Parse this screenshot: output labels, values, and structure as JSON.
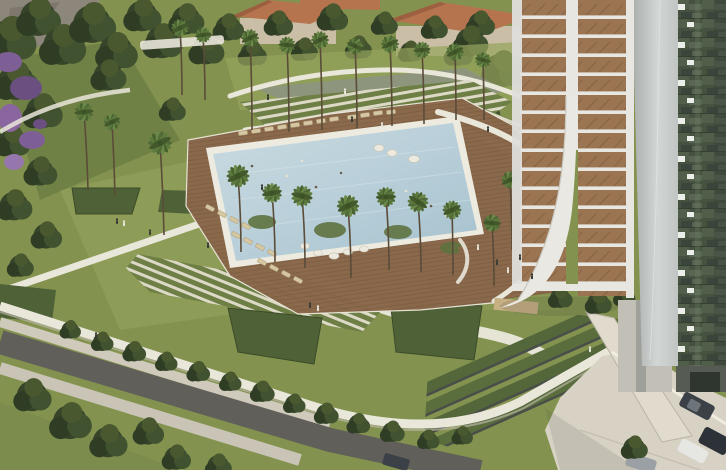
{
  "image": {
    "width": 726,
    "height": 470,
    "kind": "aerial architectural rendering",
    "subject": "resort-style residential development: landscaped pool podium beside a high-rise balcony tower"
  },
  "elements": {
    "background": "wooded hillside with purple jacaranda blossoms",
    "top": "terracotta-roofed low-rise houses behind a palm grove",
    "amphitheater": "curved white terraced steps and planting bed above the pool",
    "pool": "long rectangular swimming pool with swimmers, white coping and timber sun deck",
    "deck_furniture": "rows of sun loungers and white bean-bag seats",
    "palms": "tall palm trees dotted across lawns and deck",
    "paths": "sweeping white garden paths across the lawns",
    "bottom": "terraced hedge gardens, white perimeter wall, sidewalks and asphalt road",
    "tower": "high-rise with timber balcony decks, white slabs, curved white fin, grey blade and dark glass curtain wall",
    "plaza": "street-level paved plaza with parked cars"
  },
  "palette": {
    "lawn": "#83934f",
    "lawn_light": "#95a45c",
    "lawn_shadow": "#5d6f3d",
    "tree_dark": "#2f3d26",
    "tree_mid": "#46552f",
    "palm": "#5d7a3e",
    "purple": "#7e5f95",
    "purple_dark": "#6a4f80",
    "mountain": "#8d867b",
    "house_wall": "#cabfa6",
    "roof": "#b5744e",
    "pool_water": "#b9cfd9",
    "pool_rim": "#edebe0",
    "deck": "#8a684b",
    "deck_line": "#6d5138",
    "lounger": "#d6c7a3",
    "path": "#e9e6da",
    "garden_bed": "#8d957c",
    "steps_green": "#6d7f45",
    "hedge": "#4f6136",
    "road": "#615f5a",
    "sidewalk": "#cfcabb",
    "plaza": "#d7d2c4",
    "wall_dark": "#4a4e49",
    "tower_slab": "#e7e6e1",
    "tower_wood": "#9b7452",
    "tower_fin": "#d2d6d4",
    "tower_fin_dark": "#a9aead",
    "tower_glass": "#46513f",
    "spandrel": "#eceee9",
    "car_dark": "#3b4146",
    "car_white": "#e6e7e3",
    "van": "#2c3237",
    "car_grey": "#9aa0a4",
    "person": "#3a3a34",
    "tan_plot": "#c7b084"
  }
}
